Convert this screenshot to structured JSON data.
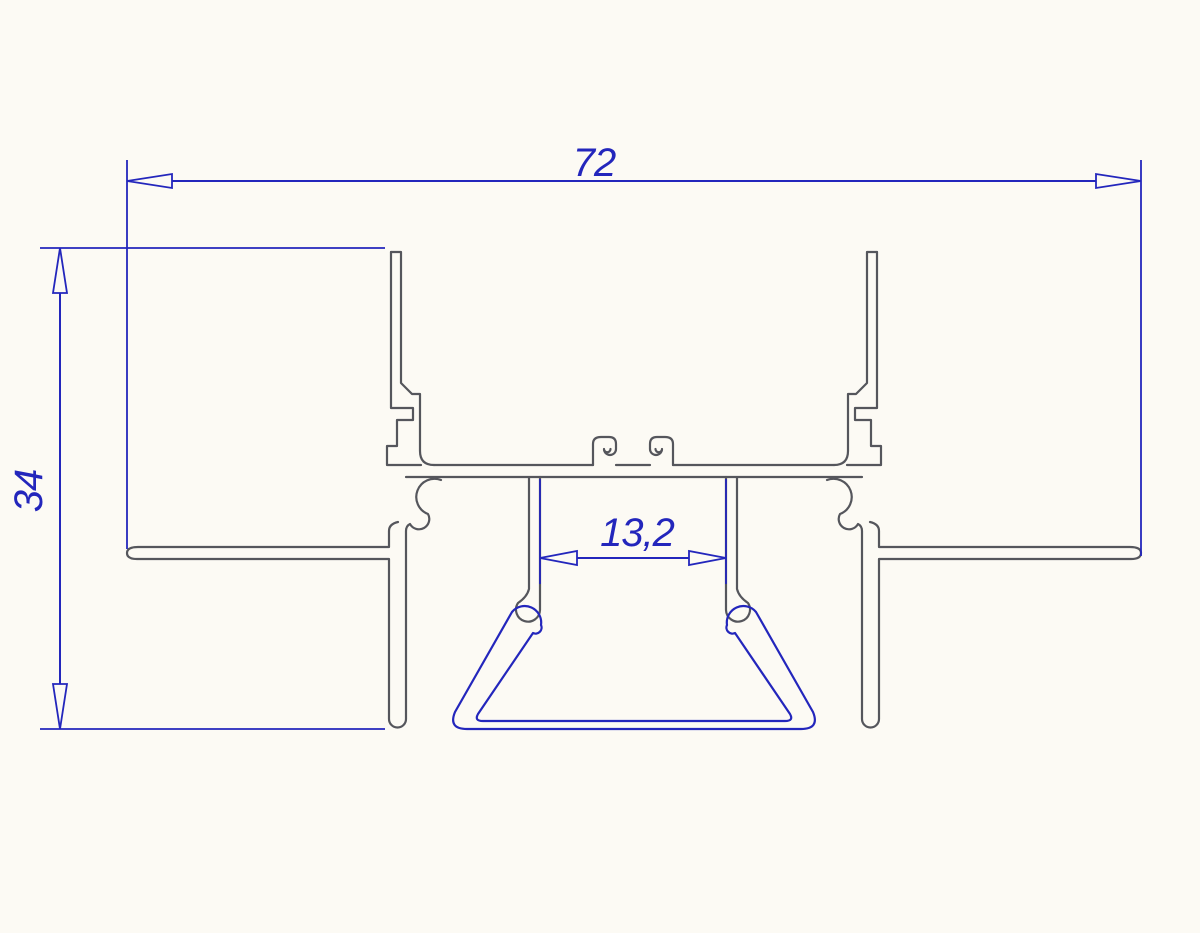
{
  "drawing": {
    "kind": "technical-cross-section",
    "subject": "recessed aluminium LED profile cross-section with cover clip",
    "background_color": "#fcfaf4",
    "outline_color": "#55565c",
    "dimension_color": "#2326bc"
  },
  "dimensions": {
    "overall_width": {
      "value": "72",
      "orientation": "horizontal",
      "position": "top"
    },
    "overall_height": {
      "value": "34",
      "orientation": "vertical",
      "position": "left"
    },
    "channel_width": {
      "value": "13,2",
      "orientation": "horizontal",
      "position": "center"
    }
  }
}
